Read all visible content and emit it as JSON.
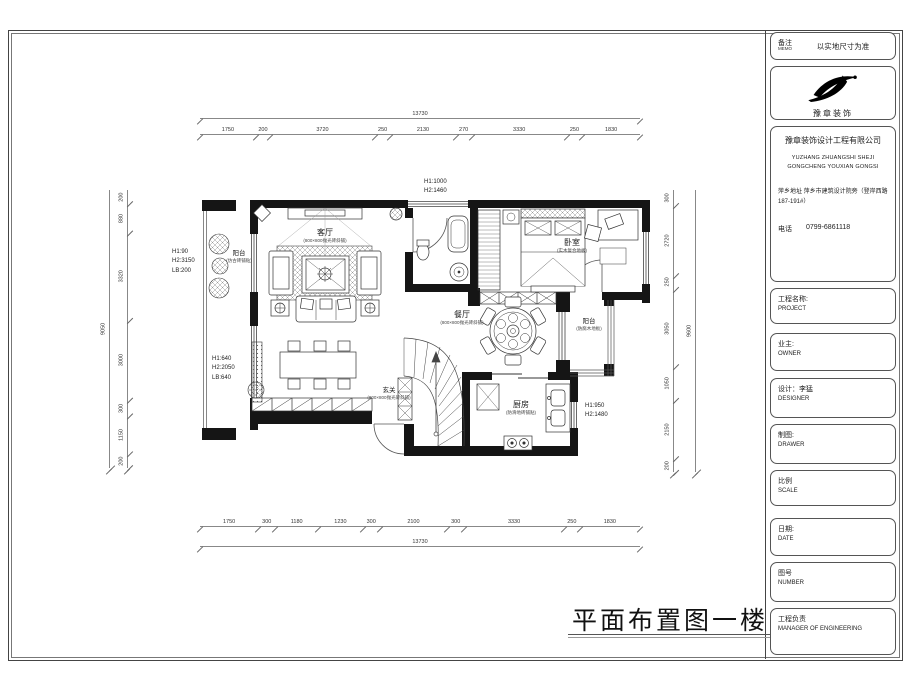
{
  "sheet": {
    "drawing_title": "平面布置图一楼"
  },
  "sidebar": {
    "memo": {
      "label": "备注",
      "label_en": "MEMO",
      "text": "以实地尺寸为准"
    },
    "logo": {
      "brand": "豫章装饰"
    },
    "company": {
      "name": "豫章装饰设计工程有限公司",
      "name_en1": "YUZHANG ZHUANGSHI SHEJI",
      "name_en2": "GONGCHENG YOUXIAN GONGSI",
      "address": "萍乡地址 萍乡市建筑设计院旁（登岸西路187-191#）",
      "phone_label": "电话",
      "phone": "0799-6861118"
    },
    "fields": [
      {
        "label": "工程名称:",
        "en": "PROJECT"
      },
      {
        "label": "业主:",
        "en": "OWNER"
      },
      {
        "label": "设计：李猛",
        "en": "DESIGNER"
      },
      {
        "label": "制图:",
        "en": "DRAWER"
      },
      {
        "label": "比例",
        "en": "SCALE"
      },
      {
        "label": "日期:",
        "en": "DATE"
      },
      {
        "label": "图号",
        "en": "NUMBER"
      },
      {
        "label": "工程负责",
        "en": "MANAGER OF ENGINEERING"
      }
    ]
  },
  "plan": {
    "rooms": {
      "living": {
        "name": "客厅",
        "sub": "(800×800抛光砖斜铺)"
      },
      "dining": {
        "name": "餐厅",
        "sub": "(800×800抛光砖斜铺)"
      },
      "entry": {
        "name": "玄关",
        "sub": "(800×800抛光砖斜铺)"
      },
      "kitchen": {
        "name": "厨房",
        "sub": "(防滑地砖铺贴)"
      },
      "bedroom": {
        "name": "卧室",
        "sub": "(实木复合地板)"
      },
      "balcony_left": {
        "name": "阳台",
        "sub": "(仿古砖铺贴)"
      },
      "balcony_right": {
        "name": "阳台",
        "sub": "(防腐木地板)"
      }
    },
    "annotations": {
      "left_balcony": [
        "H1:90",
        "H2:3150",
        "LB:200"
      ],
      "low_cabinet": [
        "H1:640",
        "H2:2050",
        "LB:640"
      ],
      "top_window": [
        "H1:1000",
        "H2:1460"
      ],
      "kitchen_window": [
        "H1:950",
        "H2:1480"
      ]
    },
    "dims": {
      "top": [
        1750,
        200,
        3720,
        250,
        2130,
        270,
        3330,
        250,
        1830
      ],
      "top_total": "13730",
      "bottom": [
        1750,
        300,
        1180,
        1230,
        300,
        2100,
        300,
        3330,
        250,
        1830
      ],
      "bottom_total": "13730",
      "left": [
        200,
        880,
        3320,
        3000,
        300,
        1150,
        200
      ],
      "left_total": "9050",
      "right": [
        300,
        2720,
        250,
        3050,
        1050,
        2150,
        200
      ],
      "right_total": "9600"
    }
  }
}
